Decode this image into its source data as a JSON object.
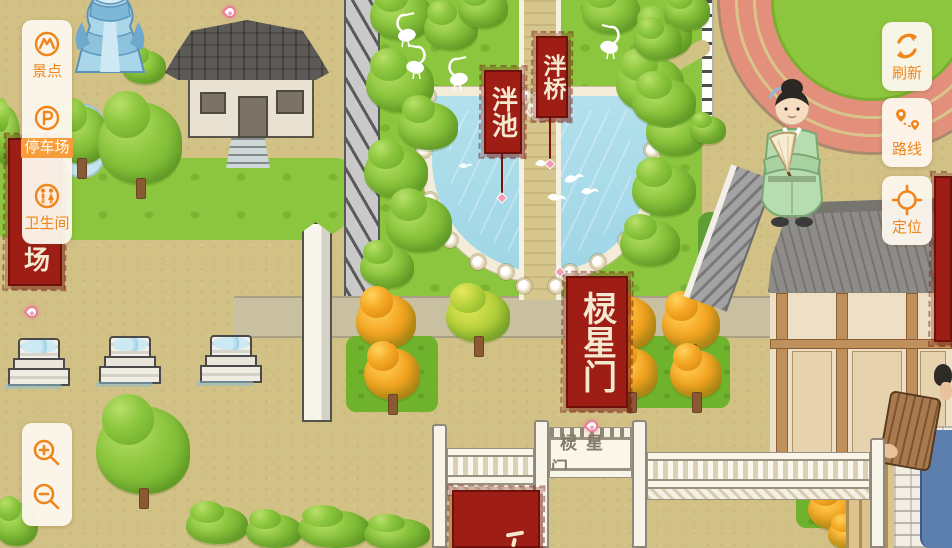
{
  "ui": {
    "left_panel": {
      "items": [
        {
          "id": "scenic",
          "label": "景点",
          "icon": "scenic-spot-icon",
          "selected": false
        },
        {
          "id": "parking",
          "label": "停车场",
          "icon": "parking-icon",
          "selected": true
        },
        {
          "id": "restroom",
          "label": "卫生间",
          "icon": "restroom-icon",
          "selected": false
        }
      ]
    },
    "right_panel": {
      "items": [
        {
          "id": "refresh",
          "label": "刷新",
          "icon": "refresh-icon"
        },
        {
          "id": "route",
          "label": "路线",
          "icon": "route-icon"
        },
        {
          "id": "locate",
          "label": "定位",
          "icon": "locate-icon"
        }
      ]
    },
    "zoom_controls": {
      "zoom_in_icon": "magnifier-plus-icon",
      "zoom_out_icon": "magnifier-minus-icon"
    }
  },
  "map": {
    "banners": {
      "pan_bridge": "泮桥",
      "pan_pool": "泮池",
      "lingxing_gate": "棂星门",
      "parking_partial": "场"
    },
    "gate_plaque": "棂星门"
  },
  "colors": {
    "accent_orange": "#f0861b",
    "banner_red": "#9e1d15",
    "pond_blue": "#a7d8e6",
    "park_green": "#8cc63e",
    "ground_tan": "#d2c185",
    "track_pink": "#e2907c"
  }
}
